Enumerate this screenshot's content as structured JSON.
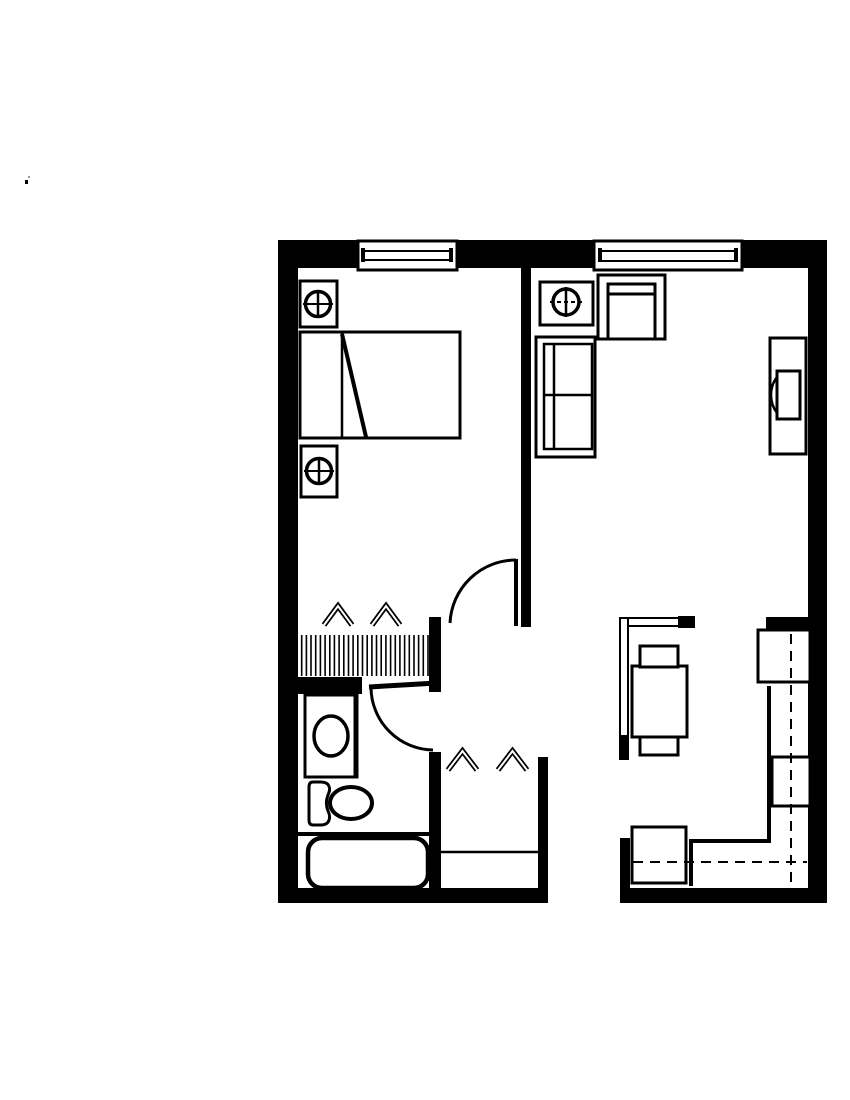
{
  "floorplan": {
    "colors": {
      "ink": "#000000",
      "paper": "#ffffff",
      "speck": "#9a9a9a"
    },
    "canvas": {
      "width": 850,
      "height": 1100
    },
    "elements": [
      {
        "name": "top-wall",
        "type": "rect",
        "x": 278,
        "y": 240,
        "w": 549,
        "h": 28,
        "fill": "ink"
      },
      {
        "name": "left-wall",
        "type": "rect",
        "x": 278,
        "y": 240,
        "w": 20,
        "h": 663,
        "fill": "ink"
      },
      {
        "name": "right-wall",
        "type": "rect",
        "x": 808,
        "y": 240,
        "w": 19,
        "h": 663,
        "fill": "ink"
      },
      {
        "name": "bottom-wall-left",
        "type": "rect",
        "x": 278,
        "y": 888,
        "w": 270,
        "h": 15,
        "fill": "ink"
      },
      {
        "name": "bottom-wall-right",
        "type": "rect",
        "x": 620,
        "y": 888,
        "w": 207,
        "h": 15,
        "fill": "ink"
      },
      {
        "name": "bedroom-living-wall",
        "type": "rect",
        "x": 521,
        "y": 268,
        "w": 10,
        "h": 359,
        "fill": "ink"
      },
      {
        "name": "hall-wall-upper",
        "type": "rect",
        "x": 429,
        "y": 617,
        "w": 12,
        "h": 75,
        "fill": "ink"
      },
      {
        "name": "hall-wall-lower",
        "type": "rect",
        "x": 429,
        "y": 752,
        "w": 12,
        "h": 151,
        "fill": "ink"
      },
      {
        "name": "hall-closet-right-wall",
        "type": "rect",
        "x": 538,
        "y": 757,
        "w": 10,
        "h": 146,
        "fill": "ink"
      },
      {
        "name": "bathroom-north-wall",
        "type": "rect",
        "x": 278,
        "y": 677,
        "w": 84,
        "h": 17,
        "fill": "ink"
      },
      {
        "name": "kitchen-north-wall-stub",
        "type": "rect",
        "x": 766,
        "y": 617,
        "w": 42,
        "h": 12,
        "fill": "ink"
      },
      {
        "name": "entry-wall-stub",
        "type": "rect",
        "x": 620,
        "y": 838,
        "w": 10,
        "h": 50,
        "fill": "ink"
      },
      {
        "name": "bedroom-window-frame",
        "type": "rect",
        "x": 358,
        "y": 241,
        "w": 99,
        "h": 29,
        "fill": "paper",
        "stroke": "ink",
        "sw": 3
      },
      {
        "name": "bedroom-window-pane",
        "type": "rect",
        "x": 364,
        "y": 251,
        "w": 87,
        "h": 9,
        "fill": "paper",
        "stroke": "ink",
        "sw": 2
      },
      {
        "name": "bedroom-window-tick-left",
        "type": "rect",
        "x": 361,
        "y": 248,
        "w": 4,
        "h": 14,
        "fill": "ink"
      },
      {
        "name": "bedroom-window-tick-right",
        "type": "rect",
        "x": 449,
        "y": 248,
        "w": 4,
        "h": 14,
        "fill": "ink"
      },
      {
        "name": "living-window-frame",
        "type": "rect",
        "x": 594,
        "y": 241,
        "w": 148,
        "h": 29,
        "fill": "paper",
        "stroke": "ink",
        "sw": 3
      },
      {
        "name": "living-window-pane",
        "type": "rect",
        "x": 601,
        "y": 251,
        "w": 135,
        "h": 10,
        "fill": "paper",
        "stroke": "ink",
        "sw": 2
      },
      {
        "name": "living-window-tick-left",
        "type": "rect",
        "x": 598,
        "y": 248,
        "w": 4,
        "h": 14,
        "fill": "ink"
      },
      {
        "name": "living-window-tick-right",
        "type": "rect",
        "x": 734,
        "y": 248,
        "w": 4,
        "h": 14,
        "fill": "ink"
      },
      {
        "name": "nightstand-north",
        "type": "rect",
        "x": 300,
        "y": 281,
        "w": 37,
        "h": 46,
        "fill": "paper",
        "stroke": "ink",
        "sw": 3
      },
      {
        "name": "nightstand-north-lamp-icon",
        "type": "ellipse",
        "cx": 318,
        "cy": 304,
        "rx": 12.5,
        "ry": 12.5,
        "fill": "none",
        "stroke": "ink",
        "sw": 3.5
      },
      {
        "name": "nightstand-north-lamp-vline",
        "type": "line",
        "x1": 318,
        "y1": 290,
        "x2": 318,
        "y2": 318,
        "stroke": "ink",
        "sw": 2.5
      },
      {
        "name": "nightstand-north-lamp-hline",
        "type": "line",
        "x1": 303,
        "y1": 304,
        "x2": 333,
        "y2": 304,
        "stroke": "ink",
        "sw": 2
      },
      {
        "name": "bed",
        "type": "rect",
        "x": 300,
        "y": 332,
        "w": 160,
        "h": 106,
        "fill": "paper",
        "stroke": "ink",
        "sw": 3
      },
      {
        "name": "bed-pillow-line",
        "type": "line",
        "x1": 342,
        "y1": 333,
        "x2": 342,
        "y2": 437,
        "stroke": "ink",
        "sw": 2.5
      },
      {
        "name": "bed-fold-line",
        "type": "line",
        "x1": 342,
        "y1": 334,
        "x2": 366,
        "y2": 437,
        "stroke": "ink",
        "sw": 4
      },
      {
        "name": "nightstand-south",
        "type": "rect",
        "x": 301,
        "y": 446,
        "w": 36,
        "h": 51,
        "fill": "paper",
        "stroke": "ink",
        "sw": 3
      },
      {
        "name": "nightstand-south-lamp-icon",
        "type": "ellipse",
        "cx": 319,
        "cy": 471,
        "rx": 12.5,
        "ry": 12.5,
        "fill": "none",
        "stroke": "ink",
        "sw": 3.5
      },
      {
        "name": "nightstand-south-lamp-vline",
        "type": "line",
        "x1": 319,
        "y1": 457,
        "x2": 319,
        "y2": 485,
        "stroke": "ink",
        "sw": 2.5
      },
      {
        "name": "nightstand-south-lamp-hline",
        "type": "line",
        "x1": 304,
        "y1": 471,
        "x2": 334,
        "y2": 471,
        "stroke": "ink",
        "sw": 2
      },
      {
        "name": "bedroom-closet-hatch",
        "type": "vhatch",
        "x1": 297,
        "x2": 428,
        "count": 29,
        "y1": 635,
        "y2": 676,
        "sw": 1.6,
        "stroke": "ink"
      },
      {
        "name": "hanger-chevron-icon",
        "type": "chevron",
        "x": 324,
        "y": 606,
        "w": 28,
        "h": 19
      },
      {
        "name": "hanger-chevron-icon",
        "type": "chevron",
        "x": 372,
        "y": 606,
        "w": 28,
        "h": 19
      },
      {
        "name": "bedroom-door-leaf",
        "type": "line",
        "x1": 516,
        "y1": 559,
        "x2": 516,
        "y2": 626,
        "stroke": "ink",
        "sw": 4
      },
      {
        "name": "bedroom-door-swing",
        "type": "path",
        "d": "M516,560 A66,66 0 0 0 450,623",
        "fill": "none",
        "stroke": "ink",
        "sw": 3
      },
      {
        "name": "bathroom-door-leaf",
        "type": "line",
        "x1": 369,
        "y1": 687,
        "x2": 437,
        "y2": 683,
        "stroke": "ink",
        "sw": 5
      },
      {
        "name": "bathroom-door-swing",
        "type": "path",
        "d": "M371,688 A63,63 0 0 0 433,750",
        "fill": "none",
        "stroke": "ink",
        "sw": 3
      },
      {
        "name": "side-table",
        "type": "rect",
        "x": 540,
        "y": 282,
        "w": 53,
        "h": 43,
        "fill": "paper",
        "stroke": "ink",
        "sw": 3
      },
      {
        "name": "side-table-lamp-icon",
        "type": "ellipse",
        "cx": 566,
        "cy": 302,
        "rx": 13,
        "ry": 13,
        "fill": "none",
        "stroke": "ink",
        "sw": 3.5
      },
      {
        "name": "side-table-lamp-vline",
        "type": "line",
        "x1": 566,
        "y1": 287,
        "x2": 566,
        "y2": 317,
        "stroke": "ink",
        "sw": 2.5
      },
      {
        "name": "side-table-lamp-hline",
        "type": "line",
        "x1": 550,
        "y1": 302,
        "x2": 582,
        "y2": 302,
        "stroke": "ink",
        "sw": 2,
        "dash": "4 3"
      },
      {
        "name": "armchair-outer",
        "type": "rect",
        "x": 598,
        "y": 275,
        "w": 67,
        "h": 64,
        "fill": "paper",
        "stroke": "ink",
        "sw": 3
      },
      {
        "name": "armchair-inner",
        "type": "polyline",
        "points": "608,339 608,284 655,284 655,339",
        "fill": "none",
        "stroke": "ink",
        "sw": 3
      },
      {
        "name": "armchair-back-line",
        "type": "line",
        "x1": 608,
        "y1": 294,
        "x2": 655,
        "y2": 294,
        "stroke": "ink",
        "sw": 3
      },
      {
        "name": "sofa-outer",
        "type": "rect",
        "x": 536,
        "y": 337,
        "w": 59,
        "h": 120,
        "fill": "paper",
        "stroke": "ink",
        "sw": 3
      },
      {
        "name": "sofa-inner",
        "type": "rect",
        "x": 544,
        "y": 344,
        "w": 48,
        "h": 105,
        "fill": "none",
        "stroke": "ink",
        "sw": 2.5
      },
      {
        "name": "sofa-back-line",
        "type": "line",
        "x1": 554,
        "y1": 344,
        "x2": 554,
        "y2": 449,
        "stroke": "ink",
        "sw": 2.5
      },
      {
        "name": "sofa-cushion-divider",
        "type": "line",
        "x1": 544,
        "y1": 395,
        "x2": 592,
        "y2": 395,
        "stroke": "ink",
        "sw": 2.5
      },
      {
        "name": "tv-console",
        "type": "rect",
        "x": 770,
        "y": 338,
        "w": 36,
        "h": 116,
        "fill": "paper",
        "stroke": "ink",
        "sw": 3
      },
      {
        "name": "tv",
        "type": "rect",
        "x": 777,
        "y": 371,
        "w": 23,
        "h": 48,
        "fill": "paper",
        "stroke": "ink",
        "sw": 3
      },
      {
        "name": "tv-screen-arc",
        "type": "path",
        "d": "M777,377 A30,30 0 0 0 777,413",
        "fill": "none",
        "stroke": "ink",
        "sw": 2.5
      },
      {
        "name": "dining-partition-h",
        "type": "rect",
        "x": 620,
        "y": 618,
        "w": 60,
        "h": 8,
        "fill": "paper",
        "stroke": "ink",
        "sw": 2
      },
      {
        "name": "dining-partition-v",
        "type": "rect",
        "x": 620,
        "y": 618,
        "w": 8,
        "h": 120,
        "fill": "paper",
        "stroke": "ink",
        "sw": 2
      },
      {
        "name": "dining-partition-cap-east",
        "type": "rect",
        "x": 678,
        "y": 616,
        "w": 17,
        "h": 12,
        "fill": "ink"
      },
      {
        "name": "dining-partition-cap-south",
        "type": "rect",
        "x": 619,
        "y": 735,
        "w": 10,
        "h": 25,
        "fill": "ink"
      },
      {
        "name": "dining-table",
        "type": "rect",
        "x": 632,
        "y": 666,
        "w": 55,
        "h": 71,
        "fill": "paper",
        "stroke": "ink",
        "sw": 3
      },
      {
        "name": "dining-chair-north",
        "type": "rect",
        "x": 640,
        "y": 646,
        "w": 38,
        "h": 21,
        "fill": "paper",
        "stroke": "ink",
        "sw": 3
      },
      {
        "name": "dining-chair-south",
        "type": "rect",
        "x": 640,
        "y": 737,
        "w": 38,
        "h": 18,
        "fill": "paper",
        "stroke": "ink",
        "sw": 3
      },
      {
        "name": "kitchen-counter-edge",
        "type": "polyline",
        "points": "769,686 769,841 691,841 691,886",
        "fill": "none",
        "stroke": "ink",
        "sw": 4
      },
      {
        "name": "refrigerator",
        "type": "rect",
        "x": 758,
        "y": 630,
        "w": 52,
        "h": 52,
        "fill": "paper",
        "stroke": "ink",
        "sw": 3
      },
      {
        "name": "sink-cabinet",
        "type": "rect",
        "x": 772,
        "y": 757,
        "w": 38,
        "h": 49,
        "fill": "paper",
        "stroke": "ink",
        "sw": 3
      },
      {
        "name": "range",
        "type": "rect",
        "x": 632,
        "y": 827,
        "w": 54,
        "h": 56,
        "fill": "paper",
        "stroke": "ink",
        "sw": 3
      },
      {
        "name": "counter-centerline-v",
        "type": "line",
        "x1": 791,
        "y1": 634,
        "x2": 791,
        "y2": 885,
        "stroke": "ink",
        "sw": 2,
        "dash": "10 7"
      },
      {
        "name": "counter-centerline-h",
        "type": "line",
        "x1": 633,
        "y1": 862,
        "x2": 807,
        "y2": 862,
        "stroke": "ink",
        "sw": 2,
        "dash": "10 7"
      },
      {
        "name": "hall-closet-shelf",
        "type": "line",
        "x1": 441,
        "y1": 852,
        "x2": 538,
        "y2": 852,
        "stroke": "ink",
        "sw": 2.5
      },
      {
        "name": "hanger-chevron-icon",
        "type": "chevron",
        "x": 448,
        "y": 751,
        "w": 29,
        "h": 19
      },
      {
        "name": "hanger-chevron-icon",
        "type": "chevron",
        "x": 498,
        "y": 751,
        "w": 29,
        "h": 19
      },
      {
        "name": "vanity",
        "type": "rect",
        "x": 305,
        "y": 695,
        "w": 52,
        "h": 82,
        "fill": "paper",
        "stroke": "ink",
        "sw": 3
      },
      {
        "name": "vanity-right-wall",
        "type": "line",
        "x1": 356,
        "y1": 681,
        "x2": 356,
        "y2": 777,
        "stroke": "ink",
        "sw": 5
      },
      {
        "name": "bathroom-sink",
        "type": "ellipse",
        "cx": 331,
        "cy": 736,
        "rx": 17,
        "ry": 20,
        "fill": "none",
        "stroke": "ink",
        "sw": 3.5
      },
      {
        "name": "toilet-tank",
        "type": "path",
        "d": "M313,782 L321,782 C330,782 331,789 328,795 C326,800 326,806 328,811 C331,817 330,825 321,825 L313,825 C310,825 309,823 309,820 L309,787 C309,784 310,782 313,782 Z",
        "fill": "paper",
        "stroke": "ink",
        "sw": 3
      },
      {
        "name": "toilet-bowl",
        "type": "ellipse",
        "cx": 351,
        "cy": 803,
        "rx": 21,
        "ry": 16,
        "fill": "paper",
        "stroke": "ink",
        "sw": 4
      },
      {
        "name": "tub-divider",
        "type": "line",
        "x1": 298,
        "y1": 834,
        "x2": 430,
        "y2": 834,
        "stroke": "ink",
        "sw": 4
      },
      {
        "name": "bathtub",
        "type": "rect",
        "x": 308,
        "y": 838,
        "w": 120,
        "h": 50,
        "rx": 14,
        "fill": "paper",
        "stroke": "ink",
        "sw": 4.5
      },
      {
        "name": "scan-speck",
        "type": "rect",
        "x": 25,
        "y": 180,
        "w": 3,
        "h": 4,
        "fill": "ink"
      },
      {
        "name": "scan-speck",
        "type": "rect",
        "x": 28,
        "y": 176,
        "w": 2,
        "h": 2,
        "fill": "speck"
      }
    ]
  }
}
